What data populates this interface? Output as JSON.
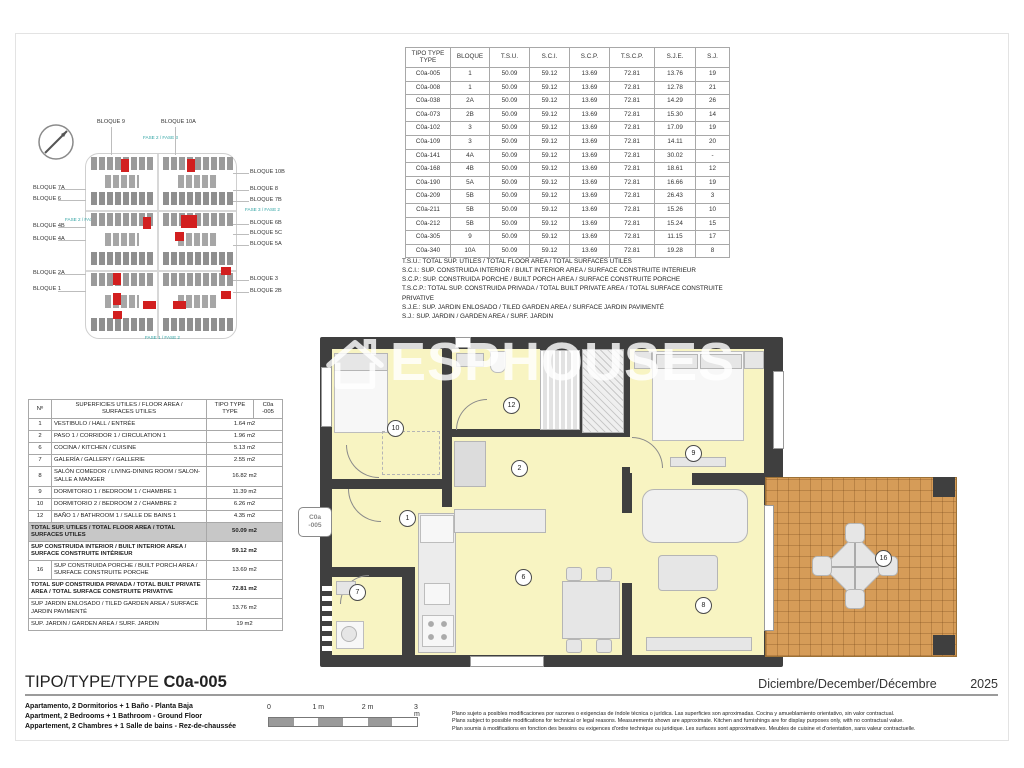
{
  "watermark": "ESPHOUSES",
  "site_plan": {
    "labels_top": [
      "BLOQUE 9",
      "BLOQUE 10A"
    ],
    "labels_left": [
      "BLOQUE 7A",
      "BLOQUE 6",
      "BLOQUE 4B",
      "BLOQUE 4A",
      "BLOQUE 2A",
      "BLOQUE 1"
    ],
    "labels_right": [
      "BLOQUE 10B",
      "BLOQUE 8",
      "BLOQUE 7B",
      "BLOQUE 6B",
      "BLOQUE 5C",
      "BLOQUE 5A",
      "BLOQUE 3",
      "BLOQUE 2B"
    ],
    "fase_labels": [
      "FASE 2 / FASE 3",
      "FASE 2 / FASE 1",
      "FASE 3 / FASE 2",
      "FASE 1 / FASE 2"
    ]
  },
  "units_table": {
    "headers": [
      "TIPO TYPE\nTYPE",
      "BLOQUE",
      "T.S.U.",
      "S.C.I.",
      "S.C.P.",
      "T.S.C.P.",
      "S.J.E.",
      "S.J."
    ],
    "rows": [
      [
        "C0a-005",
        "1",
        "50.09",
        "59.12",
        "13.69",
        "72.81",
        "13.76",
        "19"
      ],
      [
        "C0a-008",
        "1",
        "50.09",
        "59.12",
        "13.69",
        "72.81",
        "12.78",
        "21"
      ],
      [
        "C0a-038",
        "2A",
        "50.09",
        "59.12",
        "13.69",
        "72.81",
        "14.29",
        "26"
      ],
      [
        "C0a-073",
        "2B",
        "50.09",
        "59.12",
        "13.69",
        "72.81",
        "15.30",
        "14"
      ],
      [
        "C0a-102",
        "3",
        "50.09",
        "59.12",
        "13.69",
        "72.81",
        "17.09",
        "19"
      ],
      [
        "C0a-109",
        "3",
        "50.09",
        "59.12",
        "13.69",
        "72.81",
        "14.11",
        "20"
      ],
      [
        "C0a-141",
        "4A",
        "50.09",
        "59.12",
        "13.69",
        "72.81",
        "30.02",
        "-"
      ],
      [
        "C0a-168",
        "4B",
        "50.09",
        "59.12",
        "13.69",
        "72.81",
        "18.61",
        "12"
      ],
      [
        "C0a-190",
        "5A",
        "50.09",
        "59.12",
        "13.69",
        "72.81",
        "16.66",
        "19"
      ],
      [
        "C0a-209",
        "5B",
        "50.09",
        "59.12",
        "13.69",
        "72.81",
        "26.43",
        "3"
      ],
      [
        "C0a-211",
        "5B",
        "50.09",
        "59.12",
        "13.69",
        "72.81",
        "15.26",
        "10"
      ],
      [
        "C0a-212",
        "5B",
        "50.09",
        "59.12",
        "13.69",
        "72.81",
        "15.24",
        "15"
      ],
      [
        "C0a-305",
        "9",
        "50.09",
        "59.12",
        "13.69",
        "72.81",
        "11.15",
        "17"
      ],
      [
        "C0a-340",
        "10A",
        "50.09",
        "59.12",
        "13.69",
        "72.81",
        "19.28",
        "8"
      ]
    ]
  },
  "abbreviations": [
    "T.S.U.: TOTAL SUP. UTILES / TOTAL FLOOR AREA / TOTAL SURFACES UTILES",
    "S.C.I.: SUP. CONSTRUIDA INTERIOR / BUILT INTERIOR AREA / SURFACE CONSTRUITE INTERIEUR",
    "S.C.P.: SUP. CONSTRUIDA PORCHE / BUILT PORCH AREA / SURFACE CONSTRUITE PORCHE",
    "T.S.C.P.: TOTAL SUP. CONSTRUIDA PRIVADA / TOTAL BUILT PRIVATE AREA / TOTAL SURFACE CONSTRUITE PRIVATIVE",
    "S.J.E.: SUP. JARDIN ENLOSADO / TILED GARDEN AREA / SURFACE JARDIN PAVIMENTÉ",
    "S.J.: SUP. JARDIN / GARDEN AREA / SURF. JARDIN"
  ],
  "surfaces_table": {
    "col_num": "Nº",
    "col_label": "SUPERFICIES UTILES / FLOOR AREA /\nSURFACES UTILES",
    "col_type": "TIPO TYPE\nTYPE",
    "col_unit": "C0a\n-005",
    "rows": [
      {
        "type": "item",
        "num": "1",
        "label": "VESTIBULO / HALL / ENTRÉE",
        "value": "1.64 m2"
      },
      {
        "type": "item",
        "num": "2",
        "label": "PASO 1 / CORRIDOR 1 / CIRCULATION 1",
        "value": "1.96 m2"
      },
      {
        "type": "item",
        "num": "6",
        "label": "COCINA / KITCHEN / CUISINE",
        "value": "5.13 m2"
      },
      {
        "type": "item",
        "num": "7",
        "label": "GALERÍA / GALLERY / GALLERIE",
        "value": "2.55 m2"
      },
      {
        "type": "item",
        "num": "8",
        "label": "SALÓN COMEDOR / LIVING-DINING ROOM / SALON-SALLE A MANGER",
        "value": "16.82 m2"
      },
      {
        "type": "item",
        "num": "9",
        "label": "DORMITORIO 1 / BEDROOM 1 / CHAMBRE 1",
        "value": "11.39 m2"
      },
      {
        "type": "item",
        "num": "10",
        "label": "DORMITORIO 2 / BEDROOM 2 / CHAMBRE 2",
        "value": "6.26 m2"
      },
      {
        "type": "item",
        "num": "12",
        "label": "BAÑO 1 / BATHROOM 1 / SALLE DE BAINS 1",
        "value": "4.35 m2"
      },
      {
        "type": "shade",
        "num": "",
        "label": "TOTAL SUP. UTILES / TOTAL FLOOR AREA / TOTAL SURFACES UTILES",
        "value": "50.09 m2"
      },
      {
        "type": "bold",
        "num": "",
        "label": "SUP CONSTRUIDA INTERIOR / BUILT INTERIOR AREA / SURFACE CONSTRUITE INTÉRIEUR",
        "value": "59.12 m2"
      },
      {
        "type": "item",
        "num": "16",
        "label": "SUP CONSTRUIDA PORCHE / BUILT PORCH AREA / SURFACE CONSTRUITE PORCHE",
        "value": "13.69 m2"
      },
      {
        "type": "bold",
        "num": "",
        "label": "TOTAL SUP CONSTRUIDA PRIVADA / TOTAL BUILT PRIVATE AREA / TOTAL SURFACE CONSTRUITE PRIVATIVE",
        "value": "72.81 m2"
      },
      {
        "type": "plain",
        "num": "",
        "label": "SUP JARDIN ENLOSADO / TILED GARDEN AREA / SURFACE JARDIN PAVIMENTÉ",
        "value": "13.76 m2"
      },
      {
        "type": "plain",
        "num": "",
        "label": "SUP. JARDIN / GARDEN AREA / SURF. JARDIN",
        "value": "19 m2"
      }
    ]
  },
  "floor_plan": {
    "unit_tag_line1": "C0a",
    "unit_tag_line2": "-005",
    "rooms": [
      {
        "num": "1",
        "name": "vestibulo-hall"
      },
      {
        "num": "2",
        "name": "paso-corridor"
      },
      {
        "num": "6",
        "name": "cocina-kitchen"
      },
      {
        "num": "7",
        "name": "galeria-gallery"
      },
      {
        "num": "8",
        "name": "salon-comedor-living"
      },
      {
        "num": "9",
        "name": "dormitorio-1"
      },
      {
        "num": "10",
        "name": "dormitorio-2"
      },
      {
        "num": "12",
        "name": "bano-1"
      },
      {
        "num": "16",
        "name": "porche-jardin"
      }
    ]
  },
  "footer": {
    "type_label": "TIPO/TYPE/TYPE",
    "type_value": "C0a-005",
    "date": "Diciembre/December/Décembre",
    "year": "2025",
    "descriptions": [
      "Apartamento, 2 Dormitorios + 1 Baño - Planta Baja",
      "Apartment, 2 Bedrooms + 1 Bathroom - Ground Floor",
      "Appartement, 2 Chambres + 1 Salle de bains - Rez-de-chaussée"
    ],
    "scale_labels": [
      "0",
      "1 m",
      "2 m",
      "3 m"
    ],
    "disclaimer": [
      "Plano sujeto a posibles modificaciones por razones o exigencias de índole técnica o jurídica. Las superficies son aproximadas. Cocina y amueblamiento orientativo, sin valor contractual.",
      "Plans subject to possible modifications for technical or legal reasons. Measurements shown are approximate. Kitchen and furnishings are for display purposes only, with no contractual value.",
      "Plan soumis à modifications en fonction des besoins ou exigences d'ordre technique ou juridique. Les surfaces sont approximatives. Meubles de cuisine et d'orientation, sans valeur contractuelle."
    ]
  }
}
